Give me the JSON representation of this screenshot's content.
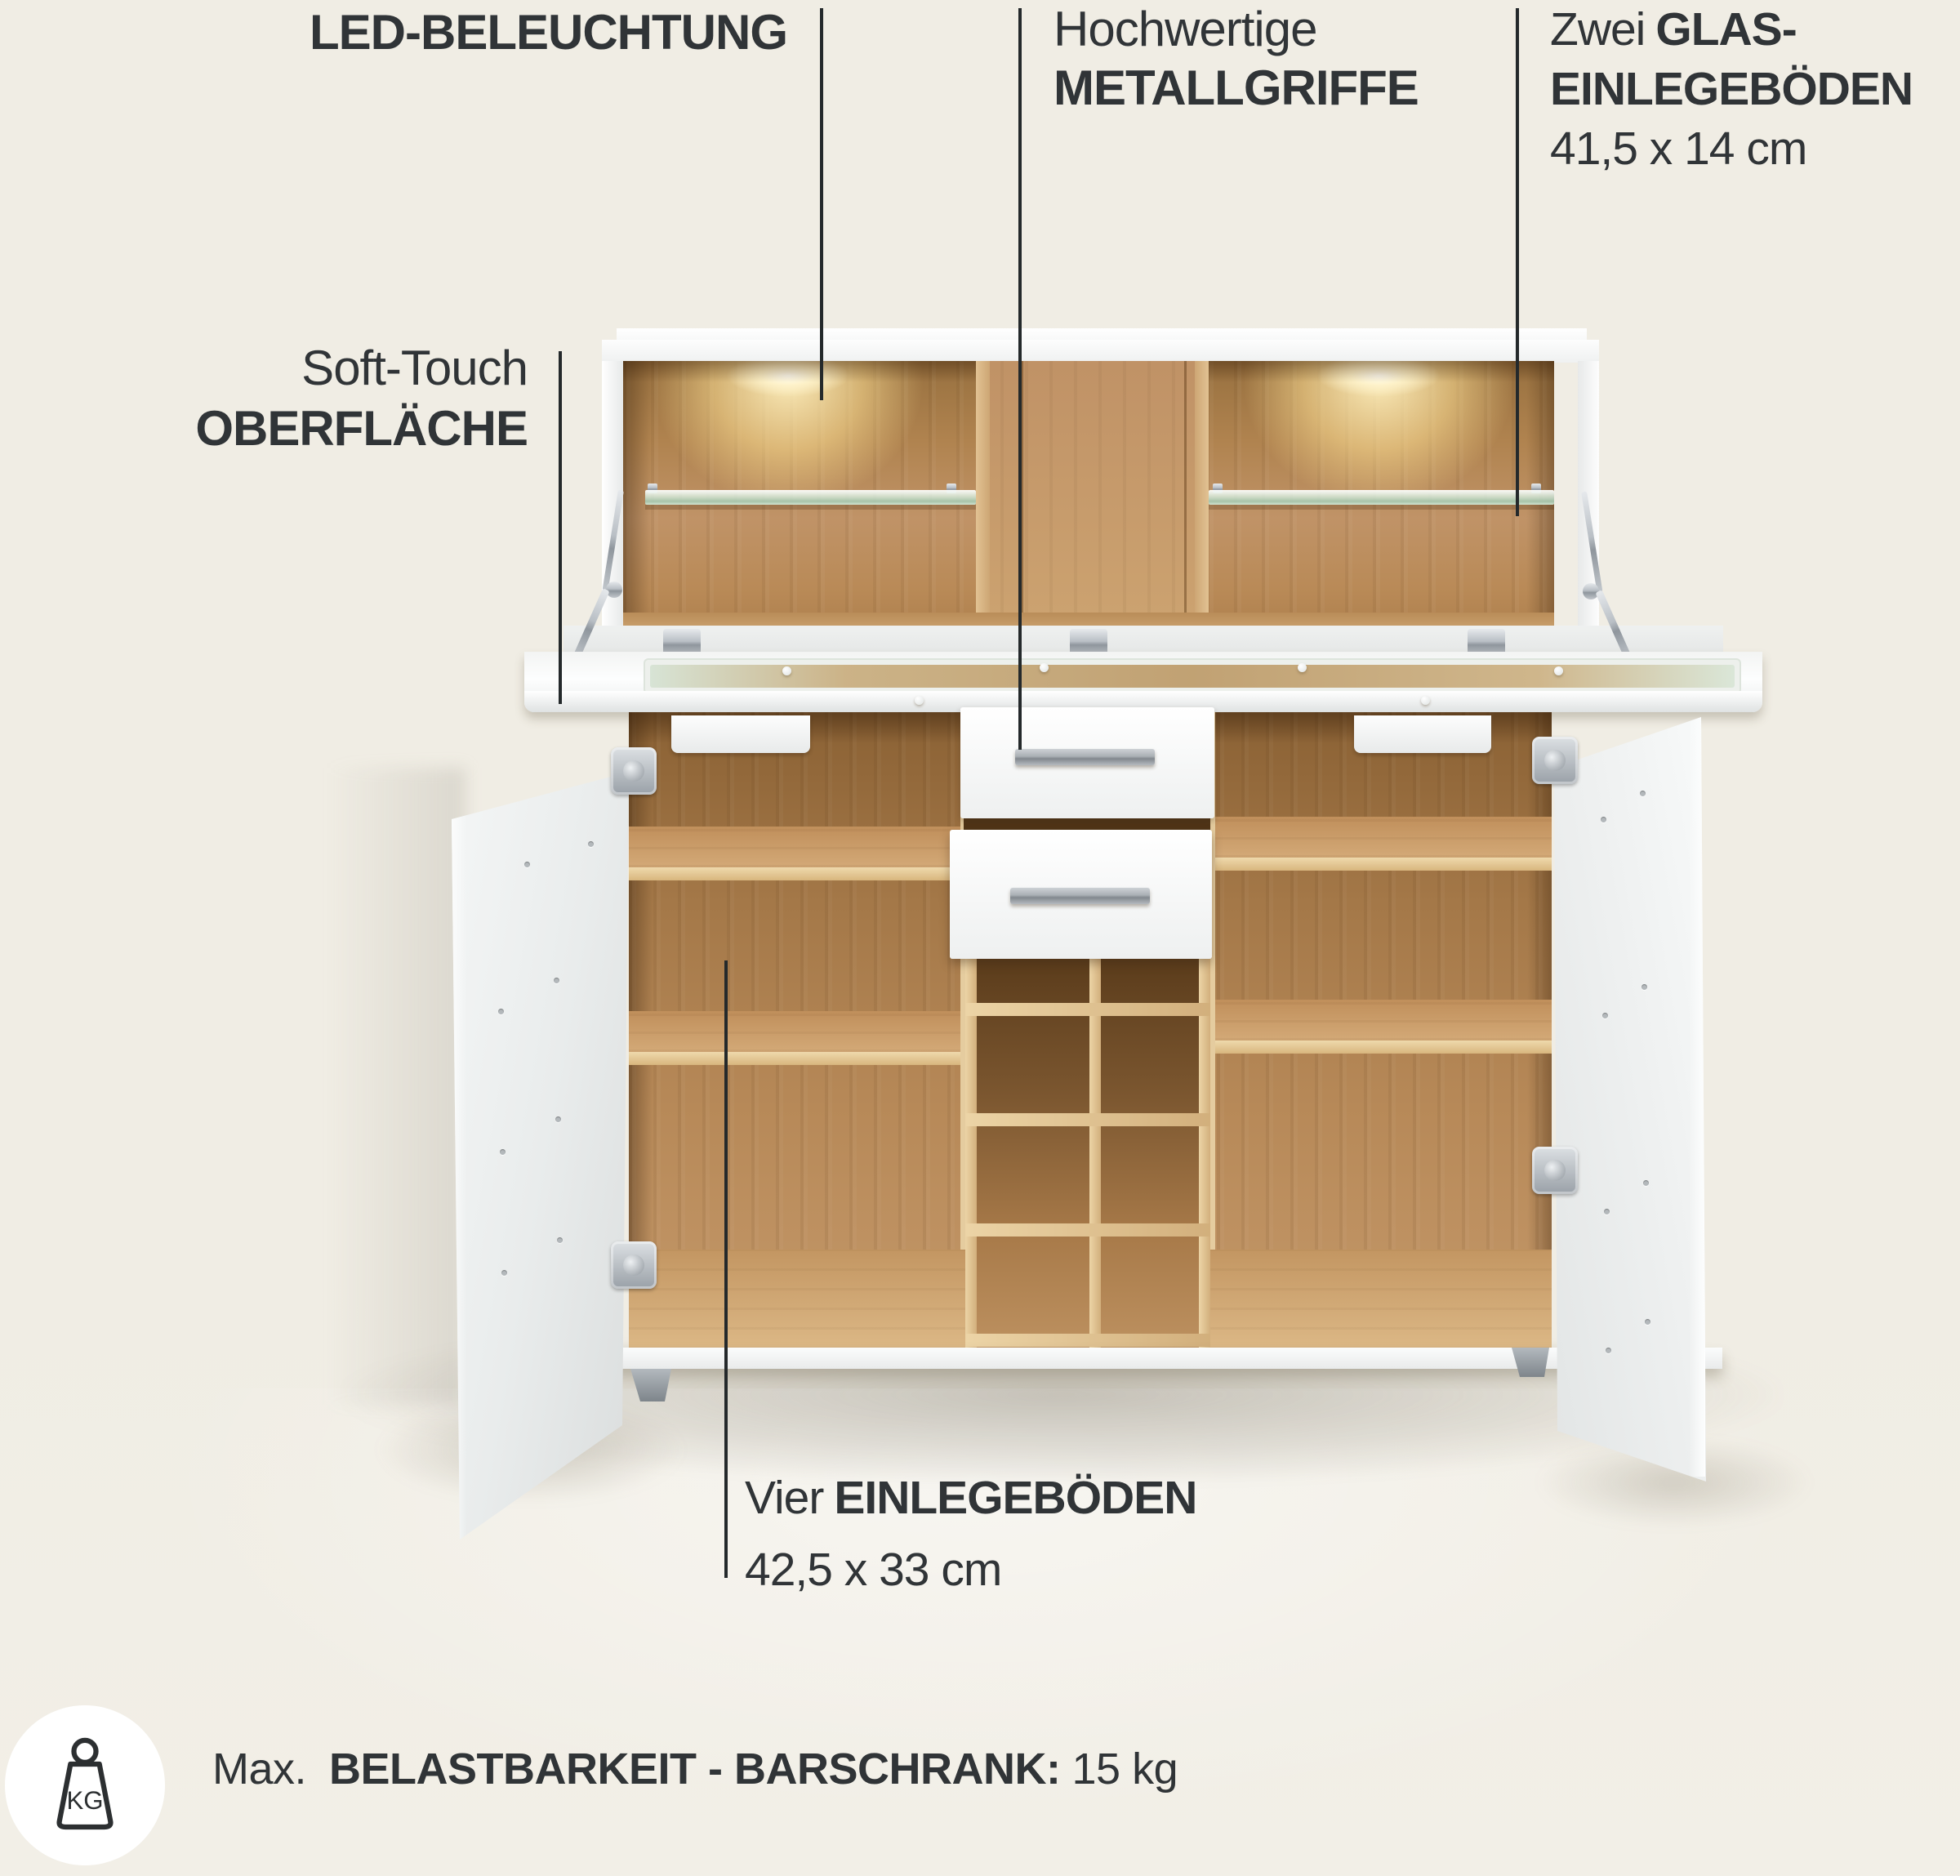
{
  "page": {
    "background": "#f0ede4",
    "text_color": "#303437",
    "line_color": "#24292b",
    "wood_color": "#b98a57",
    "cabinet_color": "#f4f5f5",
    "glass_color": "#cfe3d6",
    "led_glow_color": "#ffe9b4",
    "metal_color": "#aab0b5"
  },
  "callouts": {
    "led": {
      "label": "LED-BELEUCHTUNG"
    },
    "handles": {
      "intro": "Hochwertige",
      "label": "METALLGRIFFE"
    },
    "glass_shelves": {
      "intro": "Zwei",
      "label_line1": "GLAS-",
      "label_line2": "EINLEGEBÖDEN",
      "size": "41,5 x 14 cm"
    },
    "surface": {
      "intro": "Soft-Touch",
      "label": "OBERFLÄCHE"
    },
    "shelves": {
      "intro": "Vier",
      "label": "EINLEGEBÖDEN",
      "size": "42,5 x 33 cm"
    }
  },
  "max_load": {
    "icon": "kg-weight-icon",
    "icon_text": "KG",
    "prefix": "Max.",
    "label": "BELASTBARKEIT - BARSCHRANK:",
    "value": "15 kg"
  }
}
